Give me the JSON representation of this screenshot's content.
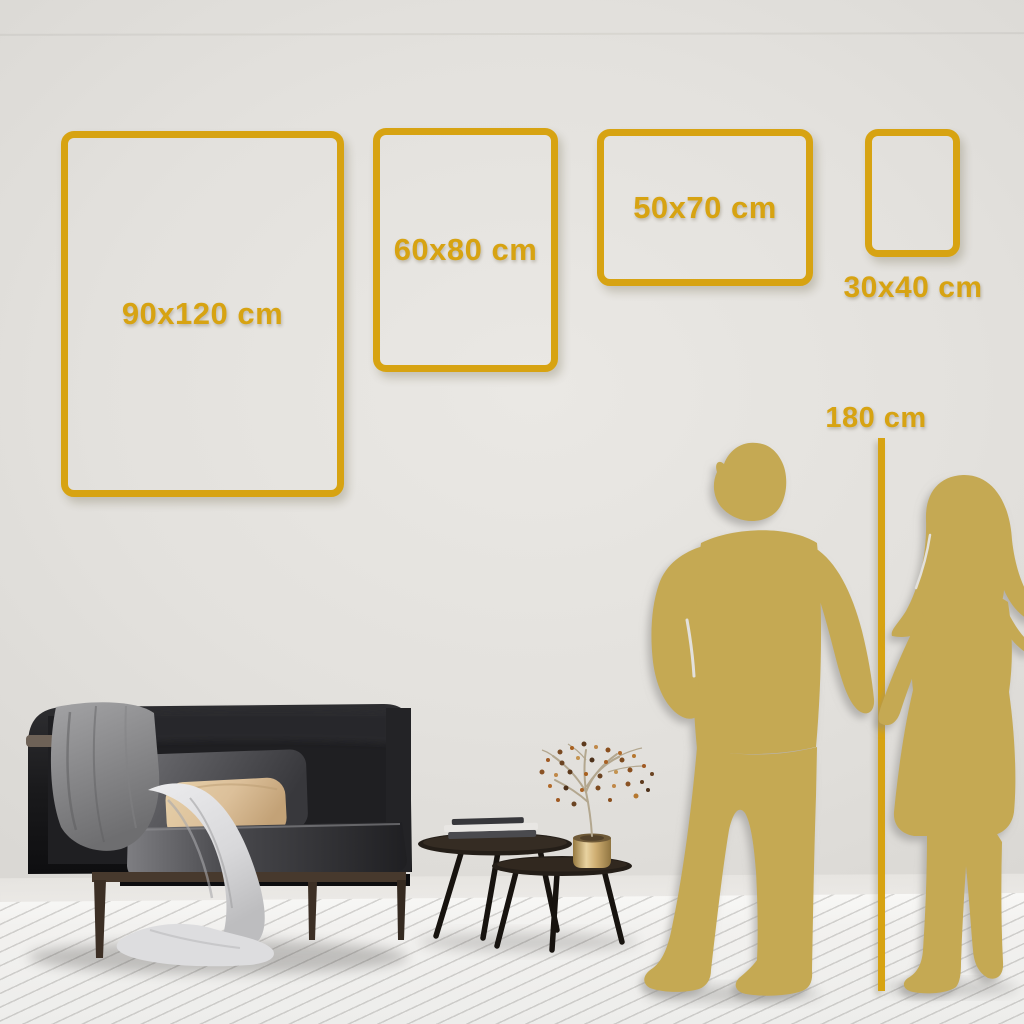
{
  "frames": [
    {
      "id": "90x120",
      "label": "90x120 cm"
    },
    {
      "id": "60x80",
      "label": "60x80 cm"
    },
    {
      "id": "50x70",
      "label": "50x70 cm"
    },
    {
      "id": "30x40",
      "label": "30x40 cm"
    }
  ],
  "height_marker": {
    "label": "180 cm"
  },
  "colors": {
    "accent_gold": "#d7a312",
    "silhouette_gold": "#c5a953"
  }
}
